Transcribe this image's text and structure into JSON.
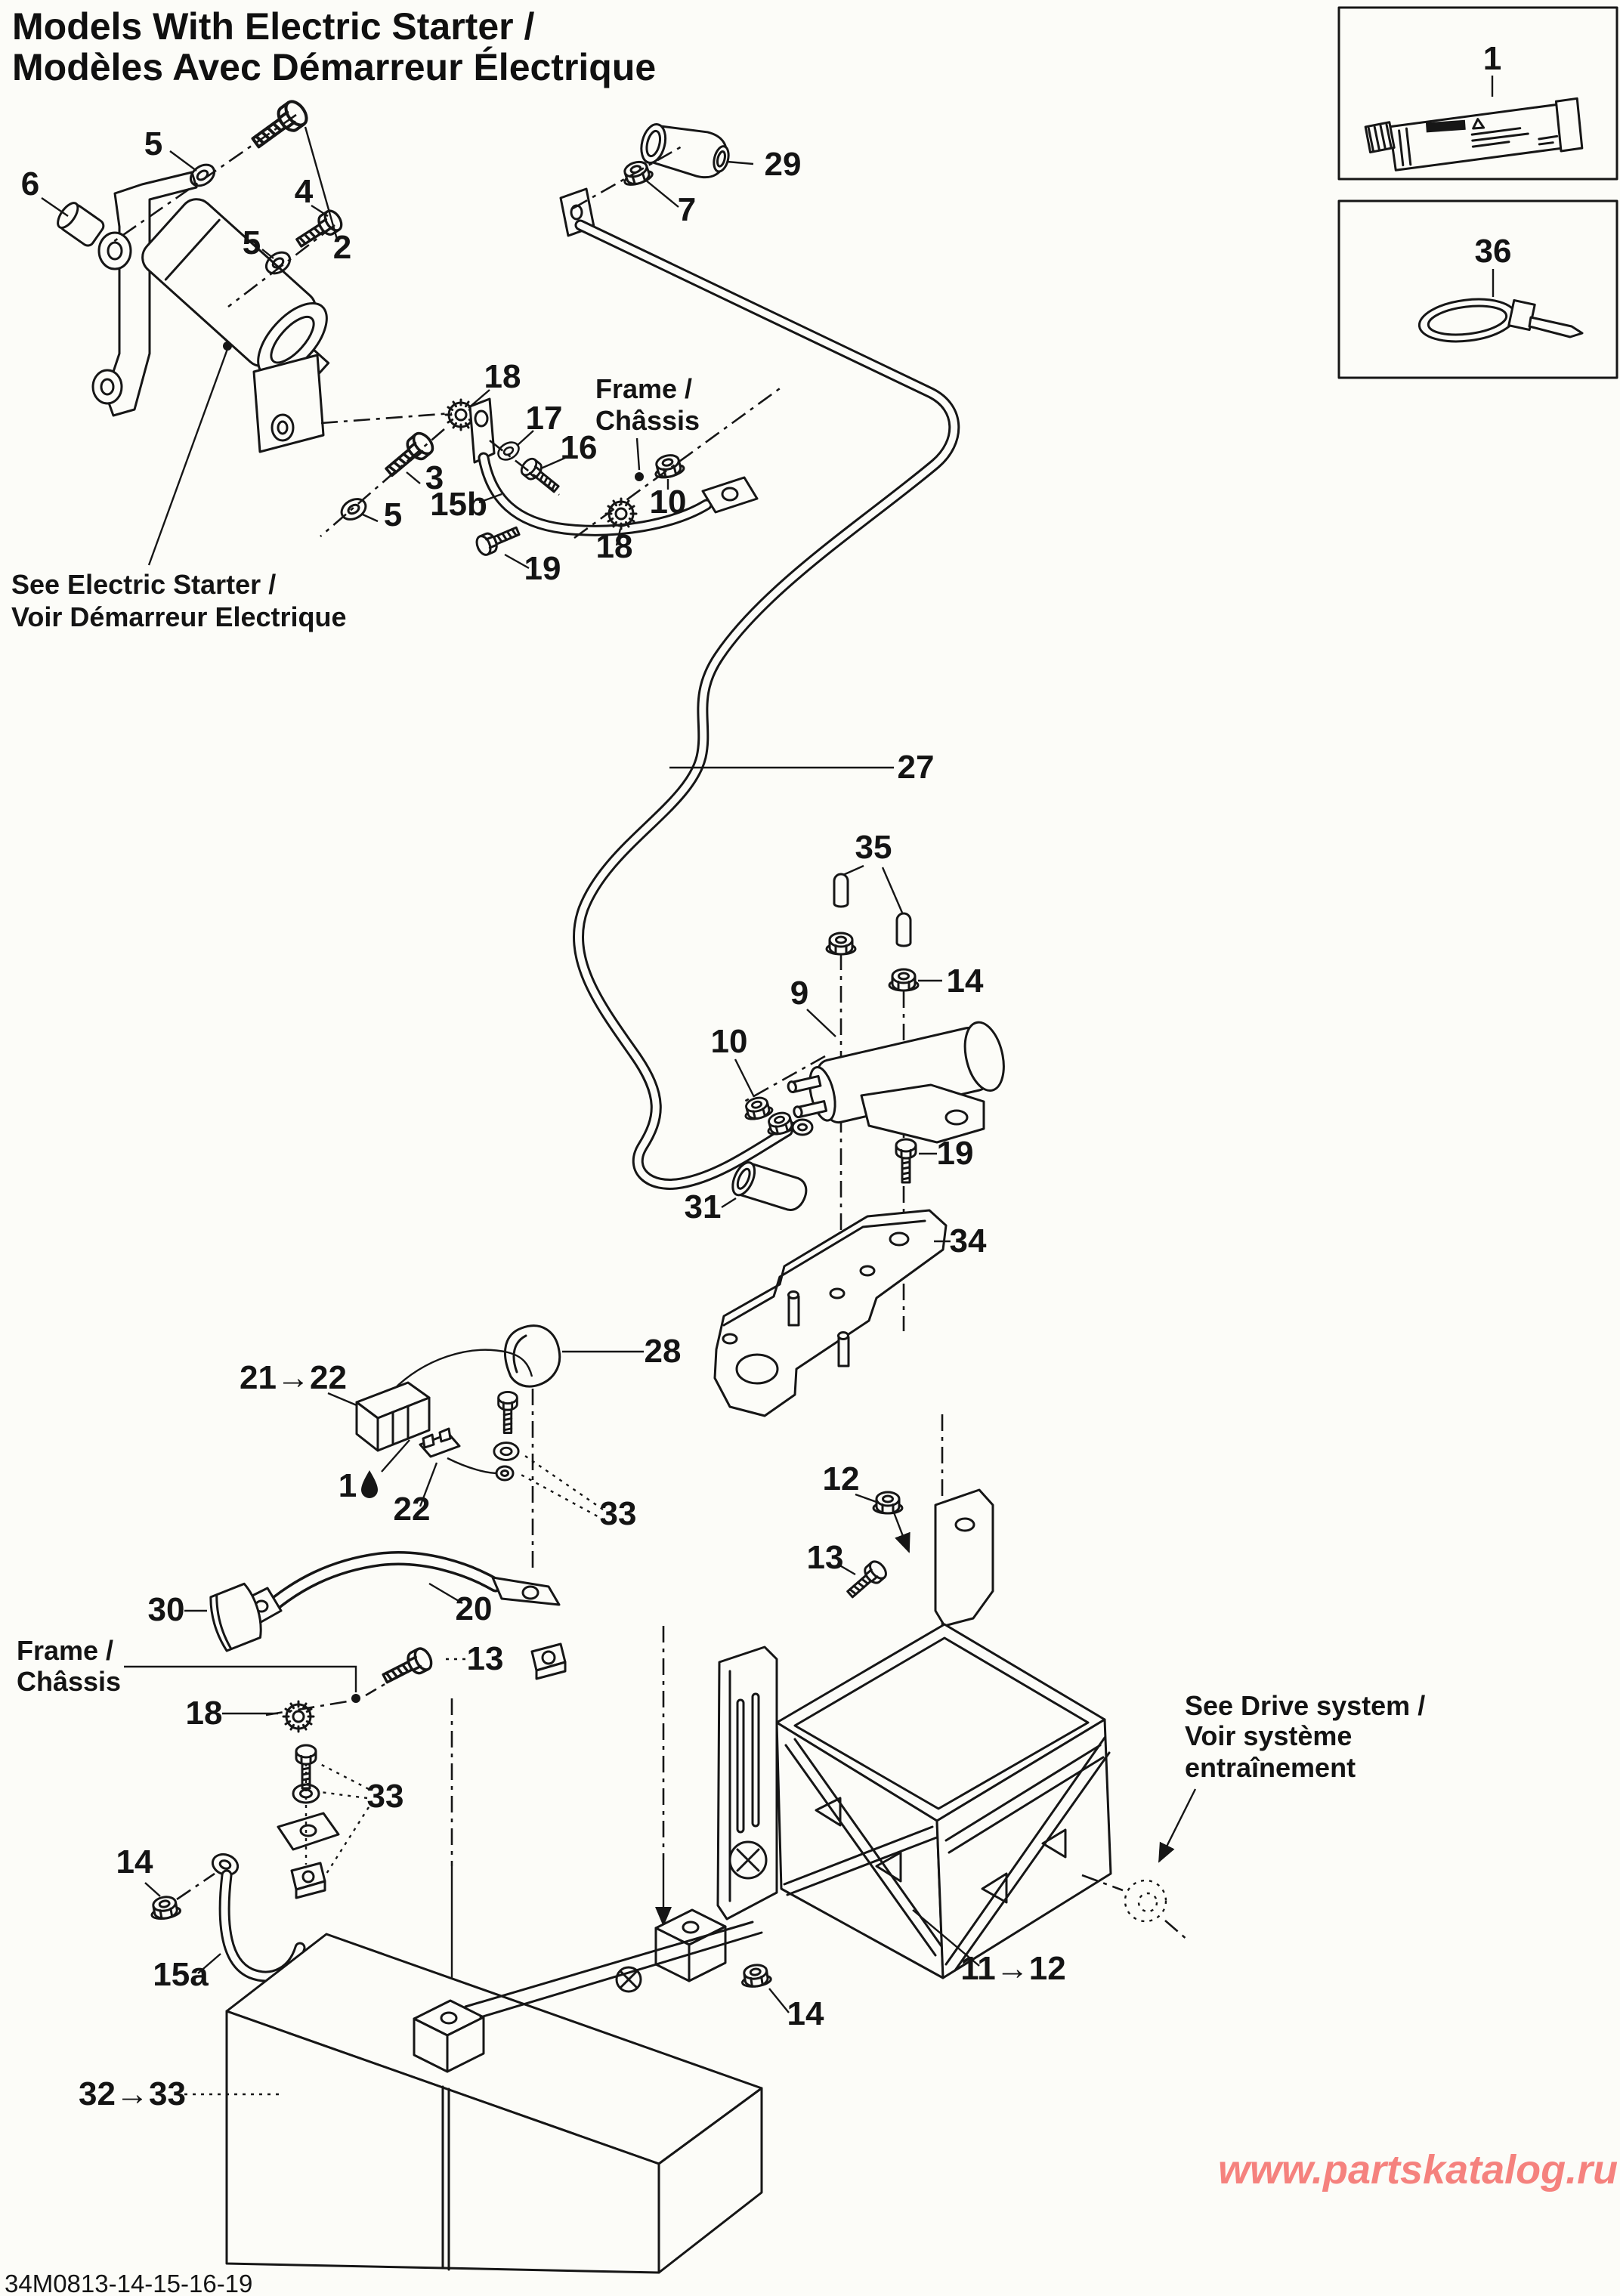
{
  "title": {
    "line1": "Models With Electric Starter /",
    "line2": "Modèles Avec Démarreur Électrique"
  },
  "notes": {
    "electric_starter_line1": "See Electric Starter /",
    "electric_starter_line2": "Voir Démarreur Electrique",
    "frame_top_line1": "Frame /",
    "frame_top_line2": "Châssis",
    "frame_bottom_line1": "Frame /",
    "frame_bottom_line2": "Châssis",
    "drive_line1": "See Drive system /",
    "drive_line2": "Voir système",
    "drive_line3": "entraînement"
  },
  "inset_parts": {
    "sealant_label": "1",
    "cable_tie_label": "36"
  },
  "callouts": [
    {
      "id": "5a",
      "label": "5"
    },
    {
      "id": "2",
      "label": "2"
    },
    {
      "id": "6",
      "label": "6"
    },
    {
      "id": "4",
      "label": "4"
    },
    {
      "id": "5b",
      "label": "5"
    },
    {
      "id": "29",
      "label": "29"
    },
    {
      "id": "7",
      "label": "7"
    },
    {
      "id": "18a",
      "label": "18"
    },
    {
      "id": "17",
      "label": "17"
    },
    {
      "id": "16",
      "label": "16"
    },
    {
      "id": "10a",
      "label": "10"
    },
    {
      "id": "3",
      "label": "3"
    },
    {
      "id": "15b",
      "label": "15b"
    },
    {
      "id": "5c",
      "label": "5"
    },
    {
      "id": "18b",
      "label": "18"
    },
    {
      "id": "19a",
      "label": "19"
    },
    {
      "id": "27",
      "label": "27"
    },
    {
      "id": "35",
      "label": "35"
    },
    {
      "id": "14a",
      "label": "14"
    },
    {
      "id": "9",
      "label": "9"
    },
    {
      "id": "10b",
      "label": "10"
    },
    {
      "id": "31",
      "label": "31"
    },
    {
      "id": "19b",
      "label": "19"
    },
    {
      "id": "34",
      "label": "34"
    },
    {
      "id": "28",
      "label": "28"
    },
    {
      "id": "21-22",
      "label": "21→22"
    },
    {
      "id": "1",
      "label": "1"
    },
    {
      "id": "22",
      "label": "22"
    },
    {
      "id": "33a",
      "label": "33"
    },
    {
      "id": "12",
      "label": "12"
    },
    {
      "id": "30",
      "label": "30"
    },
    {
      "id": "20",
      "label": "20"
    },
    {
      "id": "13a",
      "label": "13"
    },
    {
      "id": "13b",
      "label": "13"
    },
    {
      "id": "18c",
      "label": "18"
    },
    {
      "id": "33b",
      "label": "33"
    },
    {
      "id": "14b",
      "label": "14"
    },
    {
      "id": "15a",
      "label": "15a"
    },
    {
      "id": "11-12",
      "label": "11→12"
    },
    {
      "id": "14c",
      "label": "14"
    },
    {
      "id": "32-33",
      "label": "32→33"
    }
  ],
  "footer": {
    "drawing_code": "34M0813-14-15-16-19"
  },
  "watermark": {
    "text": "www.partskatalog.ru",
    "color": "#f5827e"
  }
}
